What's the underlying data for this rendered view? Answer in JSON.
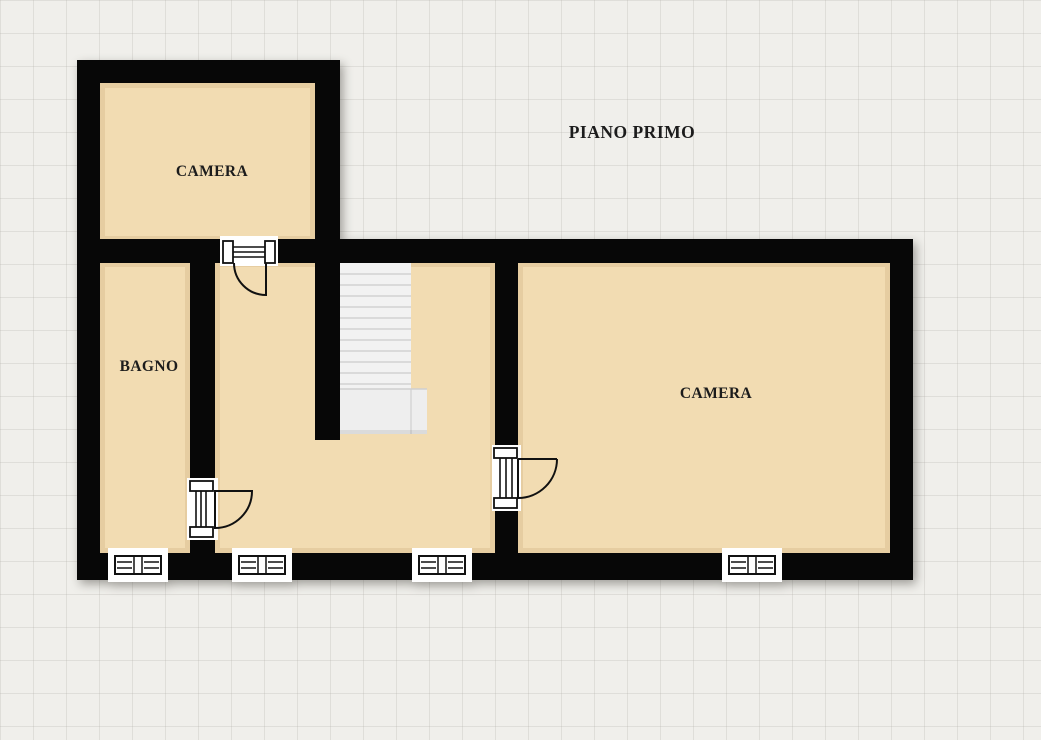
{
  "title": "PIANO PRIMO",
  "rooms": {
    "camera_top_left": {
      "label": "CAMERA"
    },
    "bagno": {
      "label": "BAGNO"
    },
    "camera_right": {
      "label": "CAMERA"
    }
  },
  "fixtures": {
    "doors": [
      {
        "name": "camera-top-left-door"
      },
      {
        "name": "bagno-door"
      },
      {
        "name": "camera-right-door"
      }
    ],
    "windows": [
      {
        "name": "bagno-window"
      },
      {
        "name": "hallway-window-left"
      },
      {
        "name": "hallway-window-right"
      },
      {
        "name": "camera-right-window"
      }
    ],
    "stairs": {
      "name": "staircase",
      "treads": 12
    }
  },
  "colors": {
    "background": "#f0efeb",
    "wall": "#070707",
    "floor": "#f2dcb2",
    "floor_edge": "#e6cda1",
    "stairs": "#f2f2f2",
    "stair_landing": "#eeeeee",
    "stair_line": "#d2d2d2",
    "label_text": "#1c1c1c"
  }
}
